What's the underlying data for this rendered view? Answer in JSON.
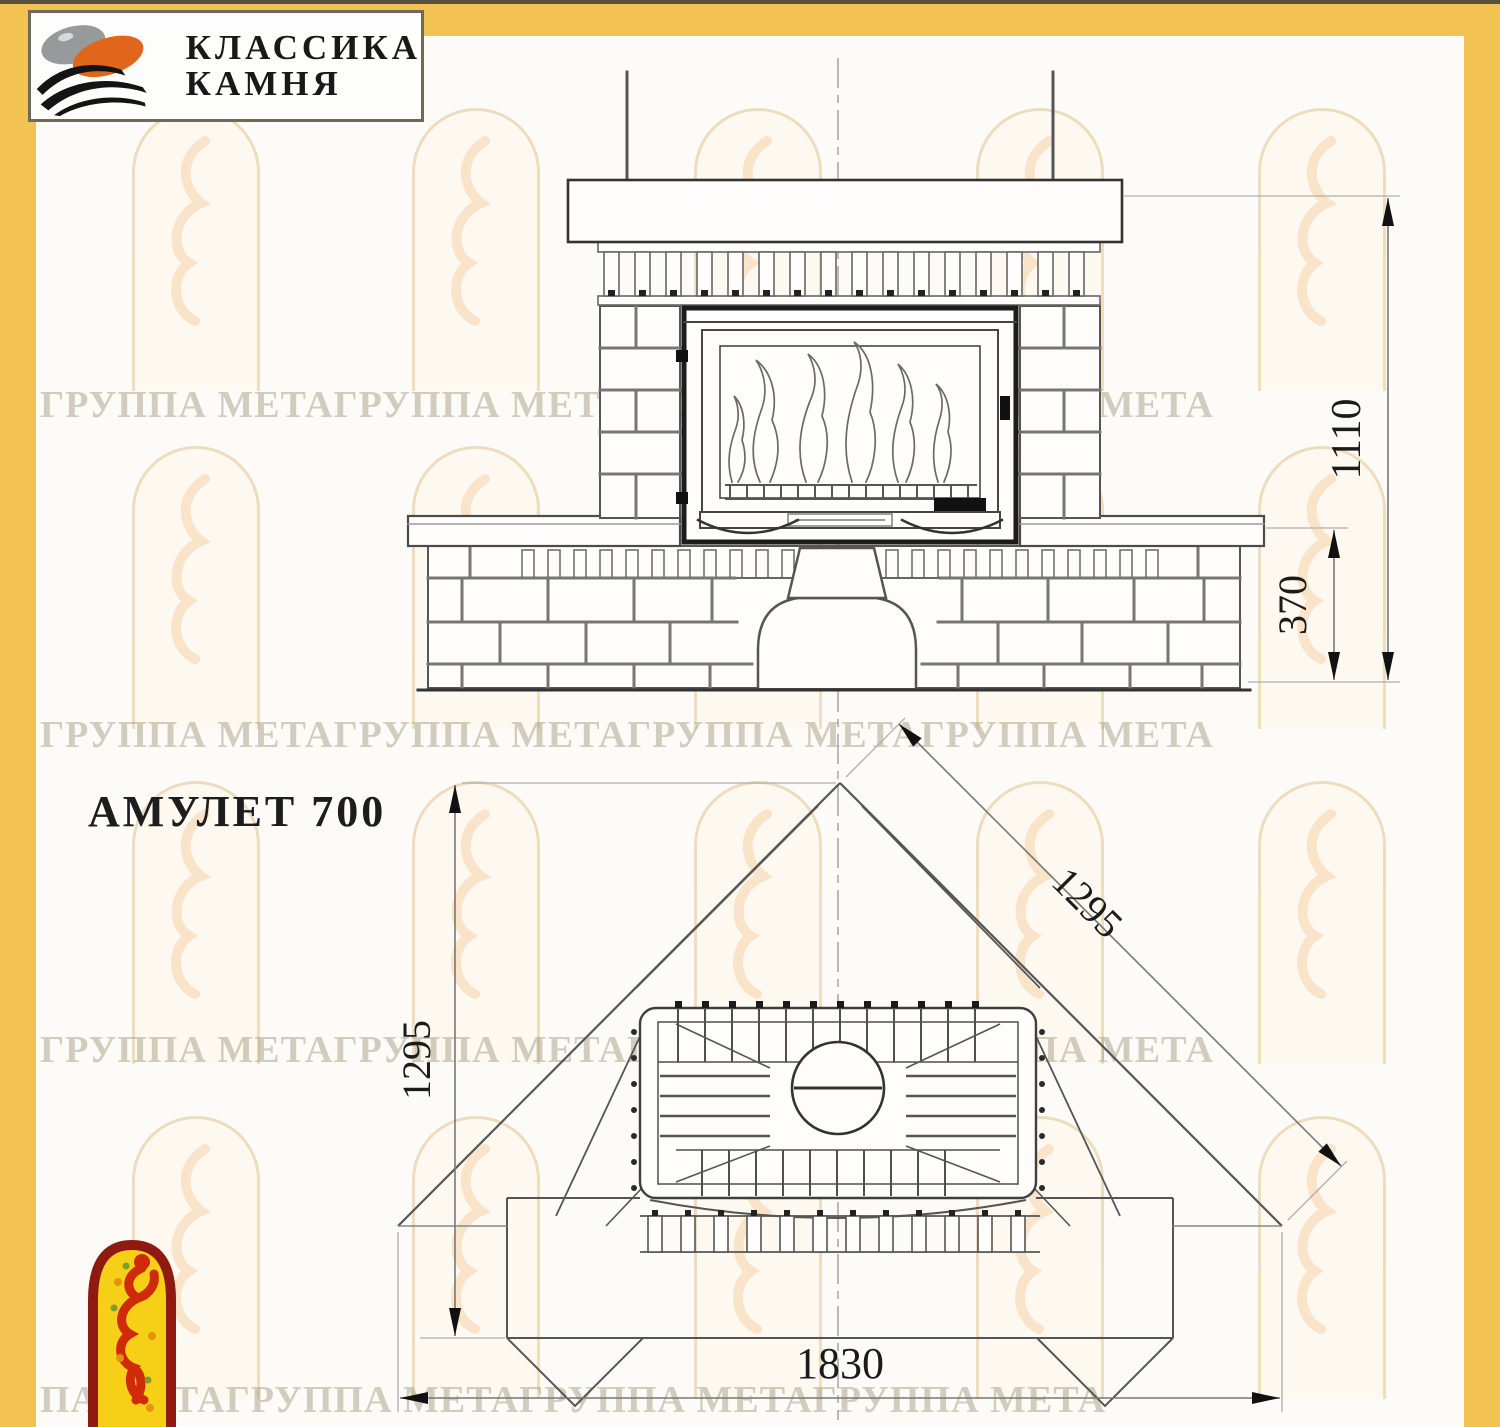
{
  "brand": {
    "line1": "КЛАССИКА",
    "line2": "КАМНЯ"
  },
  "model_label": "АМУЛЕТ 700",
  "watermark": {
    "row": "ГРУППА МЕТАГРУППА МЕТАГРУППА МЕТАГРУППА МЕТА",
    "row_alt": "ПА МЕТАГРУППА МЕТАГРУППА МЕТАГРУППА МЕТА"
  },
  "front_view": {
    "dim_total_height": "1110",
    "dim_bench_height": "370"
  },
  "plan_view": {
    "dim_side_depth": "1295",
    "dim_wall_length": "1295",
    "dim_front_width": "1830"
  },
  "colors": {
    "frame_yellow": "#f2c352",
    "line_dark": "#1c1c1c",
    "line_main": "#4b4b4b",
    "mortar_gray": "#7a7a7a",
    "watermark_tan": "#ecdbb8",
    "emblem_red": "#8e1a12",
    "emblem_yellow": "#f6cf17",
    "logo_orange": "#e0661c",
    "logo_gray": "#98999b"
  }
}
